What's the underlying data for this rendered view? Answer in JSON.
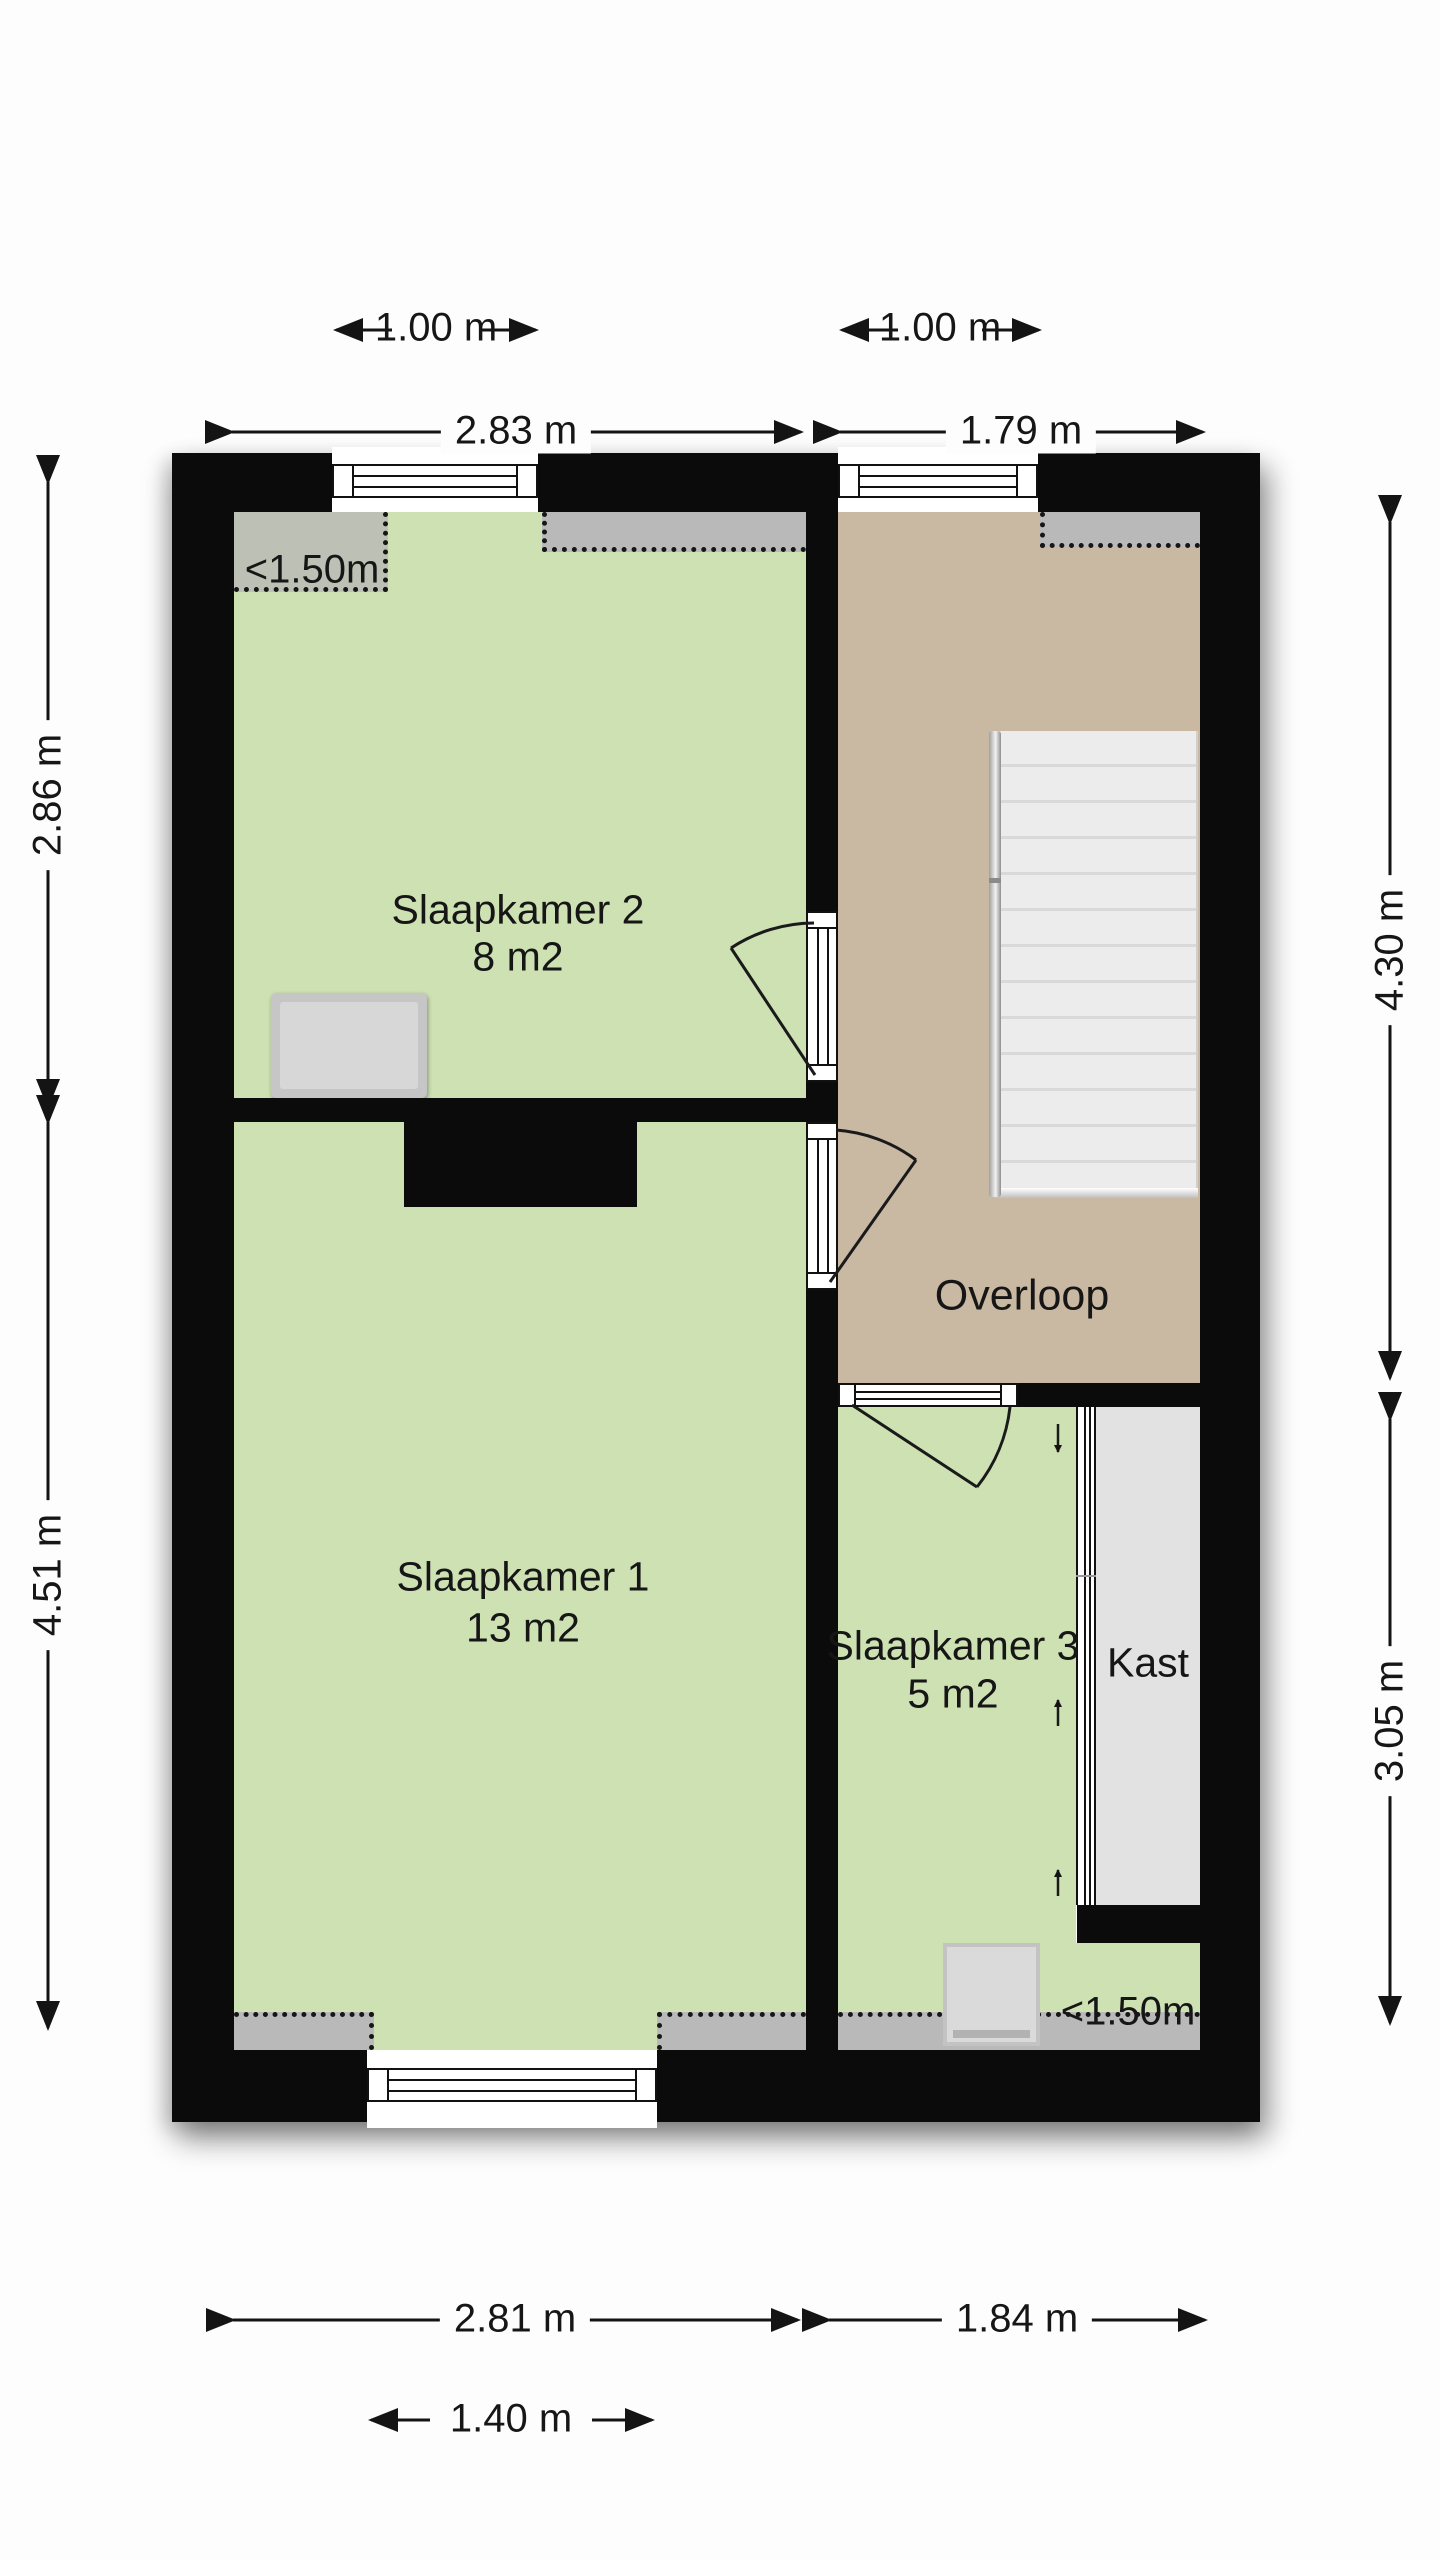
{
  "title": "Floor plan - verdieping (upper floor)",
  "rooms": {
    "slaapkamer2": {
      "name": "Slaapkamer 2",
      "area": "8 m2"
    },
    "slaapkamer1": {
      "name": "Slaapkamer 1",
      "area": "13 m2"
    },
    "slaapkamer3": {
      "name": "Slaapkamer 3",
      "area": "5 m2"
    },
    "overloop": {
      "name": "Overloop"
    },
    "kast": {
      "name": "Kast"
    }
  },
  "dimensions": {
    "window_top_left": "1.00 m",
    "top_left_span": "2.83 m",
    "window_top_right": "1.00 m",
    "top_right_span": "1.79 m",
    "left_upper": "2.86 m",
    "left_lower": "4.51 m",
    "right_upper": "4.30 m",
    "right_lower": "3.05 m",
    "bottom_left_span": "2.81 m",
    "bottom_right_span": "1.84 m",
    "window_bottom": "1.40 m"
  },
  "annotations": {
    "low_ceiling_top": "<1.50m",
    "low_ceiling_bottom": "<1.50m"
  },
  "colors": {
    "wall": "#0b0b0b",
    "bedroom_fill": "#cde1b3",
    "landing_fill": "#c9b8a2",
    "closet_fill": "#e2e2e2",
    "low_ceiling_zone": "#b9b9b9",
    "stairs_fill": "#ececec",
    "text": "#161616"
  }
}
